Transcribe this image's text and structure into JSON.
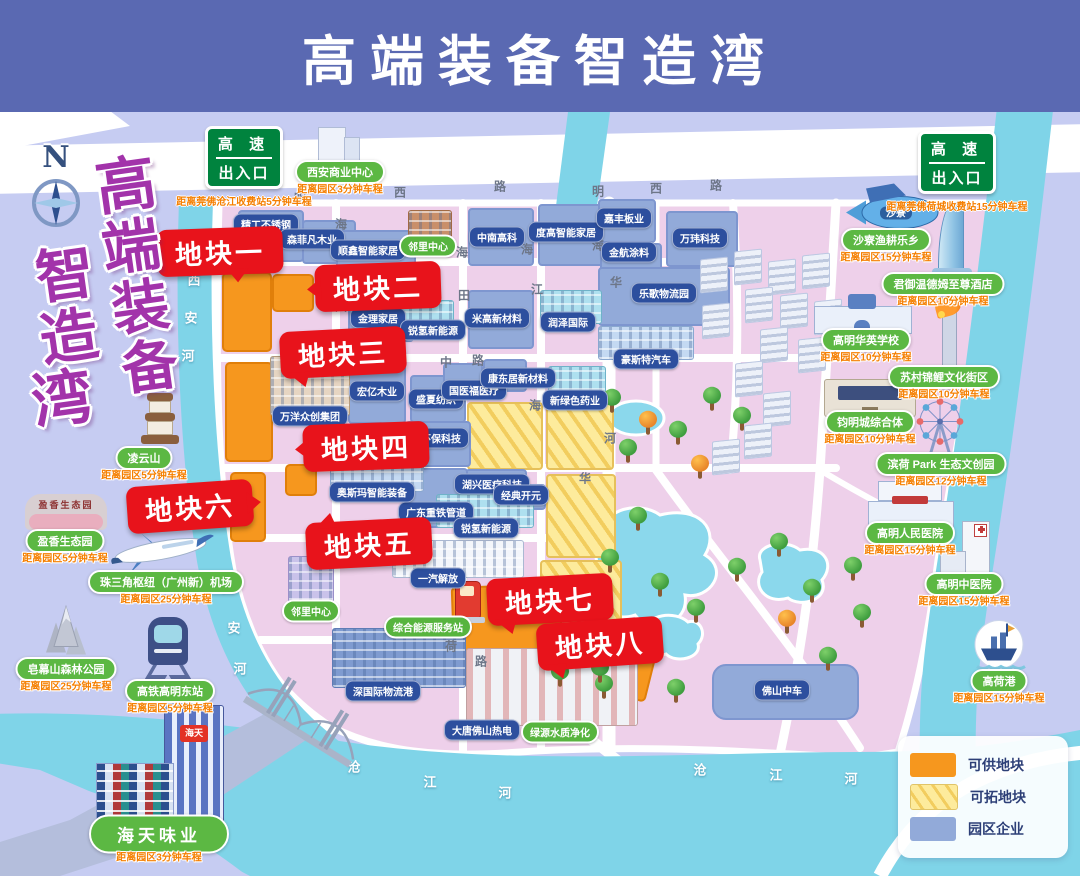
{
  "header": {
    "title": "高端装备智造湾"
  },
  "vertical_title": {
    "chars": [
      {
        "c": "高",
        "x": 96,
        "y": 156,
        "s": 60
      },
      {
        "c": "端",
        "x": 102,
        "y": 218,
        "s": 58
      },
      {
        "c": "装",
        "x": 112,
        "y": 279,
        "s": 57
      },
      {
        "c": "备",
        "x": 122,
        "y": 339,
        "s": 56
      },
      {
        "c": "智",
        "x": 36,
        "y": 246,
        "s": 58
      },
      {
        "c": "造",
        "x": 40,
        "y": 308,
        "s": 58
      },
      {
        "c": "湾",
        "x": 32,
        "y": 370,
        "s": 60
      }
    ]
  },
  "compass": {
    "label": "N"
  },
  "highway_signs": [
    {
      "line1": "高 速",
      "line2": "出入口",
      "dist": "距离莞佛沧江收费站5分钟车程",
      "x": 244,
      "y": 126
    },
    {
      "line1": "高 速",
      "line2": "出入口",
      "dist": "距离莞佛荷城收费站15分钟车程",
      "x": 957,
      "y": 131
    }
  ],
  "legend": {
    "items": [
      {
        "label": "可供地块",
        "swatch": "orange"
      },
      {
        "label": "可拓地块",
        "swatch": "striped"
      },
      {
        "label": "园区企业",
        "swatch": "blue"
      }
    ]
  },
  "colors": {
    "available_plot": "#f6971e",
    "expandable_plot": "#f2cd5e",
    "enterprise_block": "#92aad9",
    "callout_red": "#e8131b",
    "landmark_green": "#5cb843",
    "header_blue": "#5a69b2",
    "river_teal": "#7fd4e8",
    "land_pink": "#eed0ea"
  },
  "callouts": [
    {
      "label": "地块一",
      "x": 157,
      "y": 228,
      "tail": "t-b",
      "rot": -2
    },
    {
      "label": "地块二",
      "x": 315,
      "y": 263,
      "tail": "t-l",
      "rot": -2
    },
    {
      "label": "地块三",
      "x": 280,
      "y": 329,
      "tail": "t-bl",
      "rot": -3
    },
    {
      "label": "地块四",
      "x": 303,
      "y": 423,
      "tail": "t-l",
      "rot": -2
    },
    {
      "label": "地块六",
      "x": 127,
      "y": 483,
      "tail": "t-r",
      "rot": -4
    },
    {
      "label": "地块五",
      "x": 306,
      "y": 520,
      "tail": "t-tl",
      "rot": -3
    },
    {
      "label": "地块七",
      "x": 487,
      "y": 576,
      "tail": "t-bl",
      "rot": -3
    },
    {
      "label": "地块八",
      "x": 537,
      "y": 620,
      "tail": "t-bl",
      "rot": -4
    }
  ],
  "orange_plots": [
    [
      222,
      272,
      46,
      76,
      0
    ],
    [
      272,
      274,
      38,
      34,
      0
    ],
    [
      225,
      362,
      44,
      96,
      0
    ],
    [
      230,
      472,
      32,
      66,
      0
    ],
    [
      285,
      464,
      28,
      28,
      0
    ],
    [
      452,
      585,
      106,
      72,
      -2
    ],
    [
      550,
      645,
      98,
      42,
      14
    ]
  ],
  "yellow_plots": [
    [
      467,
      402,
      72,
      64,
      0
    ],
    [
      546,
      402,
      64,
      64,
      0
    ],
    [
      546,
      474,
      66,
      80,
      0
    ],
    [
      540,
      560,
      78,
      102,
      0
    ]
  ],
  "blue_blocks": [
    [
      238,
      210,
      62,
      48
    ],
    [
      302,
      220,
      50,
      40
    ],
    [
      336,
      230,
      76,
      36
    ],
    [
      468,
      208,
      62,
      54
    ],
    [
      538,
      204,
      64,
      58
    ],
    [
      598,
      199,
      54,
      40
    ],
    [
      600,
      243,
      58,
      26
    ],
    [
      666,
      211,
      68,
      52
    ],
    [
      598,
      267,
      128,
      55
    ],
    [
      348,
      292,
      62,
      46
    ],
    [
      468,
      290,
      62,
      55
    ],
    [
      348,
      364,
      54,
      56
    ],
    [
      410,
      375,
      52,
      44
    ],
    [
      405,
      421,
      62,
      42
    ],
    [
      443,
      363,
      36,
      30
    ],
    [
      483,
      359,
      40,
      29
    ],
    [
      465,
      469,
      58,
      32
    ],
    [
      408,
      468,
      56,
      56
    ],
    [
      496,
      484,
      46,
      22
    ],
    [
      712,
      664,
      143,
      52,
      14
    ]
  ],
  "enterprise_labels": [
    {
      "t": "精工不锈钢",
      "x": 266,
      "y": 224
    },
    {
      "t": "森菲凡木业",
      "x": 312,
      "y": 239
    },
    {
      "t": "顺鑫智能家居",
      "x": 368,
      "y": 250
    },
    {
      "t": "邻里中心",
      "x": 428,
      "y": 246,
      "g": 1
    },
    {
      "t": "中南高科",
      "x": 497,
      "y": 237
    },
    {
      "t": "度高智能家居",
      "x": 566,
      "y": 232
    },
    {
      "t": "嘉丰板业",
      "x": 624,
      "y": 218
    },
    {
      "t": "金航涂料",
      "x": 629,
      "y": 252
    },
    {
      "t": "万玮科技",
      "x": 700,
      "y": 238
    },
    {
      "t": "乐歌物流园",
      "x": 664,
      "y": 293
    },
    {
      "t": "金理家居",
      "x": 378,
      "y": 318
    },
    {
      "t": "锐氢新能源",
      "x": 433,
      "y": 330
    },
    {
      "t": "米高新材料",
      "x": 497,
      "y": 318
    },
    {
      "t": "润泽国际",
      "x": 568,
      "y": 322
    },
    {
      "t": "豪斯特汽车",
      "x": 646,
      "y": 359
    },
    {
      "t": "万洋众创集团",
      "x": 310,
      "y": 416
    },
    {
      "t": "宏亿木业",
      "x": 377,
      "y": 391
    },
    {
      "t": "盛夏纺织",
      "x": 436,
      "y": 399
    },
    {
      "t": "科陆环保科技",
      "x": 431,
      "y": 438
    },
    {
      "t": "国医福医疗",
      "x": 474,
      "y": 390
    },
    {
      "t": "康东居新材料",
      "x": 518,
      "y": 378
    },
    {
      "t": "新绿色药业",
      "x": 575,
      "y": 400
    },
    {
      "t": "湖兴医疗科技",
      "x": 492,
      "y": 484
    },
    {
      "t": "经典开元",
      "x": 521,
      "y": 495
    },
    {
      "t": "广东重铁管道",
      "x": 436,
      "y": 512
    },
    {
      "t": "奥斯玛智能装备",
      "x": 372,
      "y": 492
    },
    {
      "t": "锐氢新能源",
      "x": 486,
      "y": 528
    },
    {
      "t": "一汽解放",
      "x": 438,
      "y": 578
    },
    {
      "t": "邻里中心",
      "x": 311,
      "y": 611,
      "g": 1
    },
    {
      "t": "综合能源服务站",
      "x": 428,
      "y": 627,
      "g": 1
    },
    {
      "t": "深国际物流港",
      "x": 383,
      "y": 691
    },
    {
      "t": "大唐佛山热电",
      "x": 482,
      "y": 730
    },
    {
      "t": "绿源水质净化",
      "x": 560,
      "y": 732,
      "g": 1
    },
    {
      "t": "佛山中车",
      "x": 782,
      "y": 690
    }
  ],
  "landmarks": [
    {
      "name": "西安商业中心",
      "dist": "距离园区3分钟车程",
      "icon": "office-tower",
      "px": 340,
      "py": 172,
      "ix": 338,
      "iy": 146
    },
    {
      "name": "凌云山",
      "dist": "距离园区5分钟车程",
      "icon": "pagoda",
      "px": 144,
      "py": 458,
      "ix": 160,
      "iy": 422
    },
    {
      "name": "盈香生态园",
      "dist": "距离园区5分钟车程",
      "icon": "mound",
      "px": 65,
      "py": 541,
      "ix": 66,
      "iy": 512,
      "logo": "盈香生态园"
    },
    {
      "name": "珠三角枢纽（广州新）机场",
      "dist": "距离园区25分钟车程",
      "icon": "plane",
      "px": 166,
      "py": 582,
      "ix": 160,
      "iy": 550
    },
    {
      "name": "皂幕山森林公园",
      "dist": "距离园区25分钟车程",
      "icon": "mountain",
      "px": 66,
      "py": 669,
      "ix": 66,
      "iy": 634
    },
    {
      "name": "高铁高明东站",
      "dist": "距离园区5分钟车程",
      "icon": "train",
      "px": 170,
      "py": 691,
      "ix": 168,
      "iy": 648
    },
    {
      "name": "海天味业",
      "dist": "距离园区3分钟车程",
      "icon": "haitian",
      "px": 159,
      "py": 834,
      "ix": 162,
      "iy": 766,
      "big": 1,
      "logo": "海天"
    },
    {
      "name": "沙寮渔耕乐乡",
      "dist": "距离园区15分钟车程",
      "icon": "fish",
      "px": 886,
      "py": 240,
      "ix": 892,
      "iy": 210,
      "logo": "沙寮"
    },
    {
      "name": "君御温德姆至尊酒店",
      "dist": "距离园区10分钟车程",
      "icon": "hotel-tower",
      "px": 943,
      "py": 284,
      "ix": 952,
      "iy": 240
    },
    {
      "name": "高明华英学校",
      "dist": "距离园区10分钟车程",
      "icon": "school",
      "px": 866,
      "py": 340,
      "ix": 862,
      "iy": 314
    },
    {
      "name": "苏村锦鲤文化街区",
      "dist": "距离园区10分钟车程",
      "icon": "koi-column",
      "px": 944,
      "py": 377,
      "ix": 948,
      "iy": 334
    },
    {
      "name": "钧明城综合体",
      "dist": "距离园区10分钟车程",
      "icon": "mall",
      "px": 870,
      "py": 422,
      "ix": 870,
      "iy": 398
    },
    {
      "name": "滨荷 Park 生态文创园",
      "dist": "距离园区12分钟车程",
      "icon": "ferris-wheel",
      "px": 941,
      "py": 464,
      "ix": 940,
      "iy": 430
    },
    {
      "name": "高明人民医院",
      "dist": "距离园区15分钟车程",
      "icon": "hospital-wide",
      "px": 910,
      "py": 533,
      "ix": 910,
      "iy": 504
    },
    {
      "name": "高明中医院",
      "dist": "距离园区15分钟车程",
      "icon": "hospital-tall",
      "px": 964,
      "py": 584,
      "ix": 966,
      "iy": 550
    },
    {
      "name": "高荷港",
      "dist": "距离园区15分钟车程",
      "icon": "ship-port",
      "px": 999,
      "py": 681,
      "ix": 999,
      "iy": 650
    }
  ],
  "street_objects": [
    {
      "icon": "gas-pump",
      "x": 468,
      "y": 602
    },
    {
      "icon": "ev-sign",
      "x": 532,
      "y": 600
    },
    {
      "icon": "bridge",
      "x": 300,
      "y": 730
    }
  ],
  "road_chars": [
    [
      "明",
      300,
      198
    ],
    [
      "西",
      400,
      192
    ],
    [
      "路",
      500,
      186
    ],
    [
      "明",
      598,
      191
    ],
    [
      "西",
      656,
      188
    ],
    [
      "路",
      716,
      185
    ],
    [
      "海",
      341,
      224
    ],
    [
      "海",
      462,
      252
    ],
    [
      "海",
      527,
      249
    ],
    [
      "海",
      598,
      245
    ],
    [
      "大",
      341,
      306
    ],
    [
      "田",
      464,
      295
    ],
    [
      "江",
      537,
      289
    ],
    [
      "华",
      616,
      282
    ],
    [
      "中",
      446,
      362
    ],
    [
      "路",
      478,
      360
    ],
    [
      "海",
      535,
      405
    ],
    [
      "河",
      610,
      438
    ],
    [
      "华",
      585,
      478
    ],
    [
      "荷",
      451,
      646
    ],
    [
      "路",
      481,
      661
    ]
  ],
  "river_chars": [
    [
      "西",
      194,
      279
    ],
    [
      "安",
      191,
      317
    ],
    [
      "河",
      188,
      355
    ],
    [
      "西",
      228,
      586
    ],
    [
      "安",
      234,
      627
    ],
    [
      "河",
      240,
      668
    ],
    [
      "沧",
      354,
      766
    ],
    [
      "江",
      430,
      781
    ],
    [
      "河",
      505,
      792
    ],
    [
      "沧",
      700,
      769
    ],
    [
      "江",
      776,
      774
    ],
    [
      "河",
      851,
      778
    ]
  ],
  "trees": [
    [
      612,
      402,
      0
    ],
    [
      648,
      424,
      1
    ],
    [
      678,
      434,
      0
    ],
    [
      628,
      452,
      0
    ],
    [
      712,
      400,
      0
    ],
    [
      742,
      420,
      0
    ],
    [
      700,
      468,
      1
    ],
    [
      638,
      520,
      0
    ],
    [
      610,
      562,
      0
    ],
    [
      585,
      592,
      0
    ],
    [
      660,
      586,
      0
    ],
    [
      696,
      612,
      0
    ],
    [
      737,
      571,
      0
    ],
    [
      779,
      546,
      0
    ],
    [
      812,
      592,
      0
    ],
    [
      787,
      623,
      1
    ],
    [
      641,
      652,
      0
    ],
    [
      604,
      688,
      0
    ],
    [
      676,
      692,
      0
    ],
    [
      853,
      570,
      0
    ],
    [
      862,
      617,
      0
    ],
    [
      828,
      660,
      0
    ],
    [
      600,
      672,
      0
    ],
    [
      560,
      676,
      0
    ]
  ],
  "clusters": [
    [
      700,
      258
    ],
    [
      734,
      250
    ],
    [
      768,
      260
    ],
    [
      802,
      254
    ],
    [
      745,
      288
    ],
    [
      780,
      294
    ],
    [
      814,
      300
    ],
    [
      702,
      304
    ],
    [
      760,
      328
    ],
    [
      798,
      338
    ],
    [
      735,
      362
    ],
    [
      763,
      392
    ],
    [
      744,
      424
    ],
    [
      712,
      440
    ]
  ],
  "buildings": [
    {
      "x": 398,
      "y": 300,
      "w": 54,
      "h": 30,
      "st": "teal"
    },
    {
      "x": 540,
      "y": 290,
      "w": 60,
      "h": 32,
      "st": "teal"
    },
    {
      "x": 598,
      "y": 326,
      "w": 94,
      "h": 32,
      "st": "lblue"
    },
    {
      "x": 548,
      "y": 366,
      "w": 56,
      "h": 32,
      "st": "teal"
    },
    {
      "x": 330,
      "y": 456,
      "w": 92,
      "h": 34,
      "st": "lblue"
    },
    {
      "x": 436,
      "y": 494,
      "w": 96,
      "h": 32,
      "st": "teal"
    },
    {
      "x": 270,
      "y": 356,
      "w": 78,
      "h": 58,
      "st": "beige"
    },
    {
      "x": 392,
      "y": 540,
      "w": 130,
      "h": 36,
      "st": "white"
    },
    {
      "x": 332,
      "y": 628,
      "w": 132,
      "h": 58,
      "st": "blue"
    },
    {
      "x": 466,
      "y": 648,
      "w": 170,
      "h": 76,
      "st": "power"
    },
    {
      "x": 288,
      "y": 556,
      "w": 44,
      "h": 52,
      "st": "purple"
    },
    {
      "x": 408,
      "y": 210,
      "w": 42,
      "h": 38,
      "st": "brown"
    }
  ]
}
